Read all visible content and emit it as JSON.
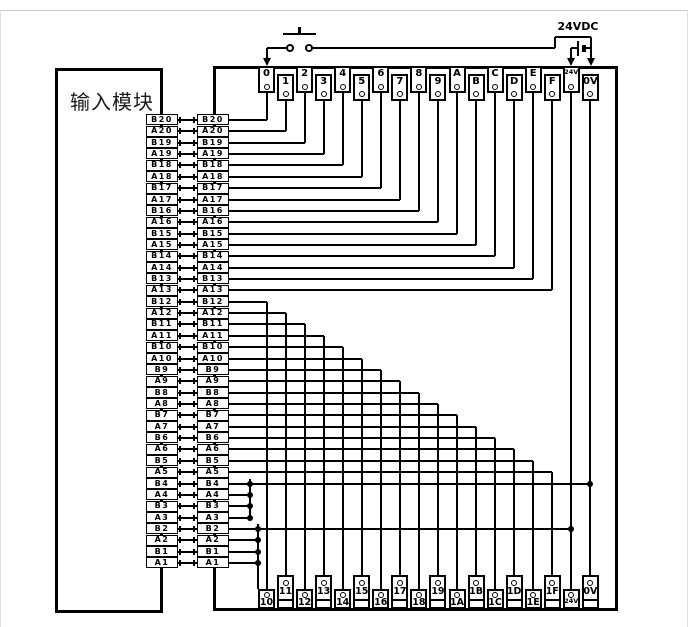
{
  "diagram": {
    "module_label": "输入模块",
    "supply_label": "24VDC",
    "switch": "pushbutton-normally-open",
    "colors": {
      "line": "#000000",
      "background": "#ffffff"
    }
  },
  "pins": [
    "B20",
    "A20",
    "B19",
    "A19",
    "B18",
    "A18",
    "B17",
    "A17",
    "B16",
    "A16",
    "B15",
    "A15",
    "B14",
    "A14",
    "B13",
    "A13",
    "B12",
    "A12",
    "B11",
    "A11",
    "B10",
    "A10",
    "B9",
    "A9",
    "B8",
    "A8",
    "B7",
    "A7",
    "B6",
    "A6",
    "B5",
    "A5",
    "B4",
    "A4",
    "B3",
    "A3",
    "B2",
    "A2",
    "B1",
    "A1"
  ],
  "top_terminals": [
    "0",
    "1",
    "2",
    "3",
    "4",
    "5",
    "6",
    "7",
    "8",
    "9",
    "A",
    "B",
    "C",
    "D",
    "E",
    "F",
    "24V",
    "0V"
  ],
  "bottom_terminals": [
    "10",
    "11",
    "12",
    "13",
    "14",
    "15",
    "16",
    "17",
    "18",
    "19",
    "1A",
    "1B",
    "1C",
    "1D",
    "1E",
    "1F",
    "24V",
    "0V"
  ],
  "connections": {
    "top": {
      "0": "B20",
      "1": "A20",
      "2": "B19",
      "3": "A19",
      "4": "B18",
      "5": "A18",
      "6": "B17",
      "7": "A17",
      "8": "B16",
      "9": "A16",
      "A": "B15",
      "B": "A15",
      "C": "B14",
      "D": "A14",
      "E": "B13",
      "F": "A13"
    },
    "bottom": {
      "10": "B12",
      "11": "A12",
      "12": "B11",
      "13": "A11",
      "14": "B10",
      "15": "A10",
      "16": "B9",
      "17": "A9",
      "18": "B8",
      "19": "A8",
      "1A": "B7",
      "1B": "A7",
      "1C": "B6",
      "1D": "A6",
      "1E": "B5",
      "1F": "A5"
    },
    "bus_to_0v_pins": [
      "B4",
      "A4",
      "B3",
      "A3"
    ],
    "bus_to_24v_pins": [
      "B2",
      "A2",
      "B1",
      "A1"
    ]
  }
}
